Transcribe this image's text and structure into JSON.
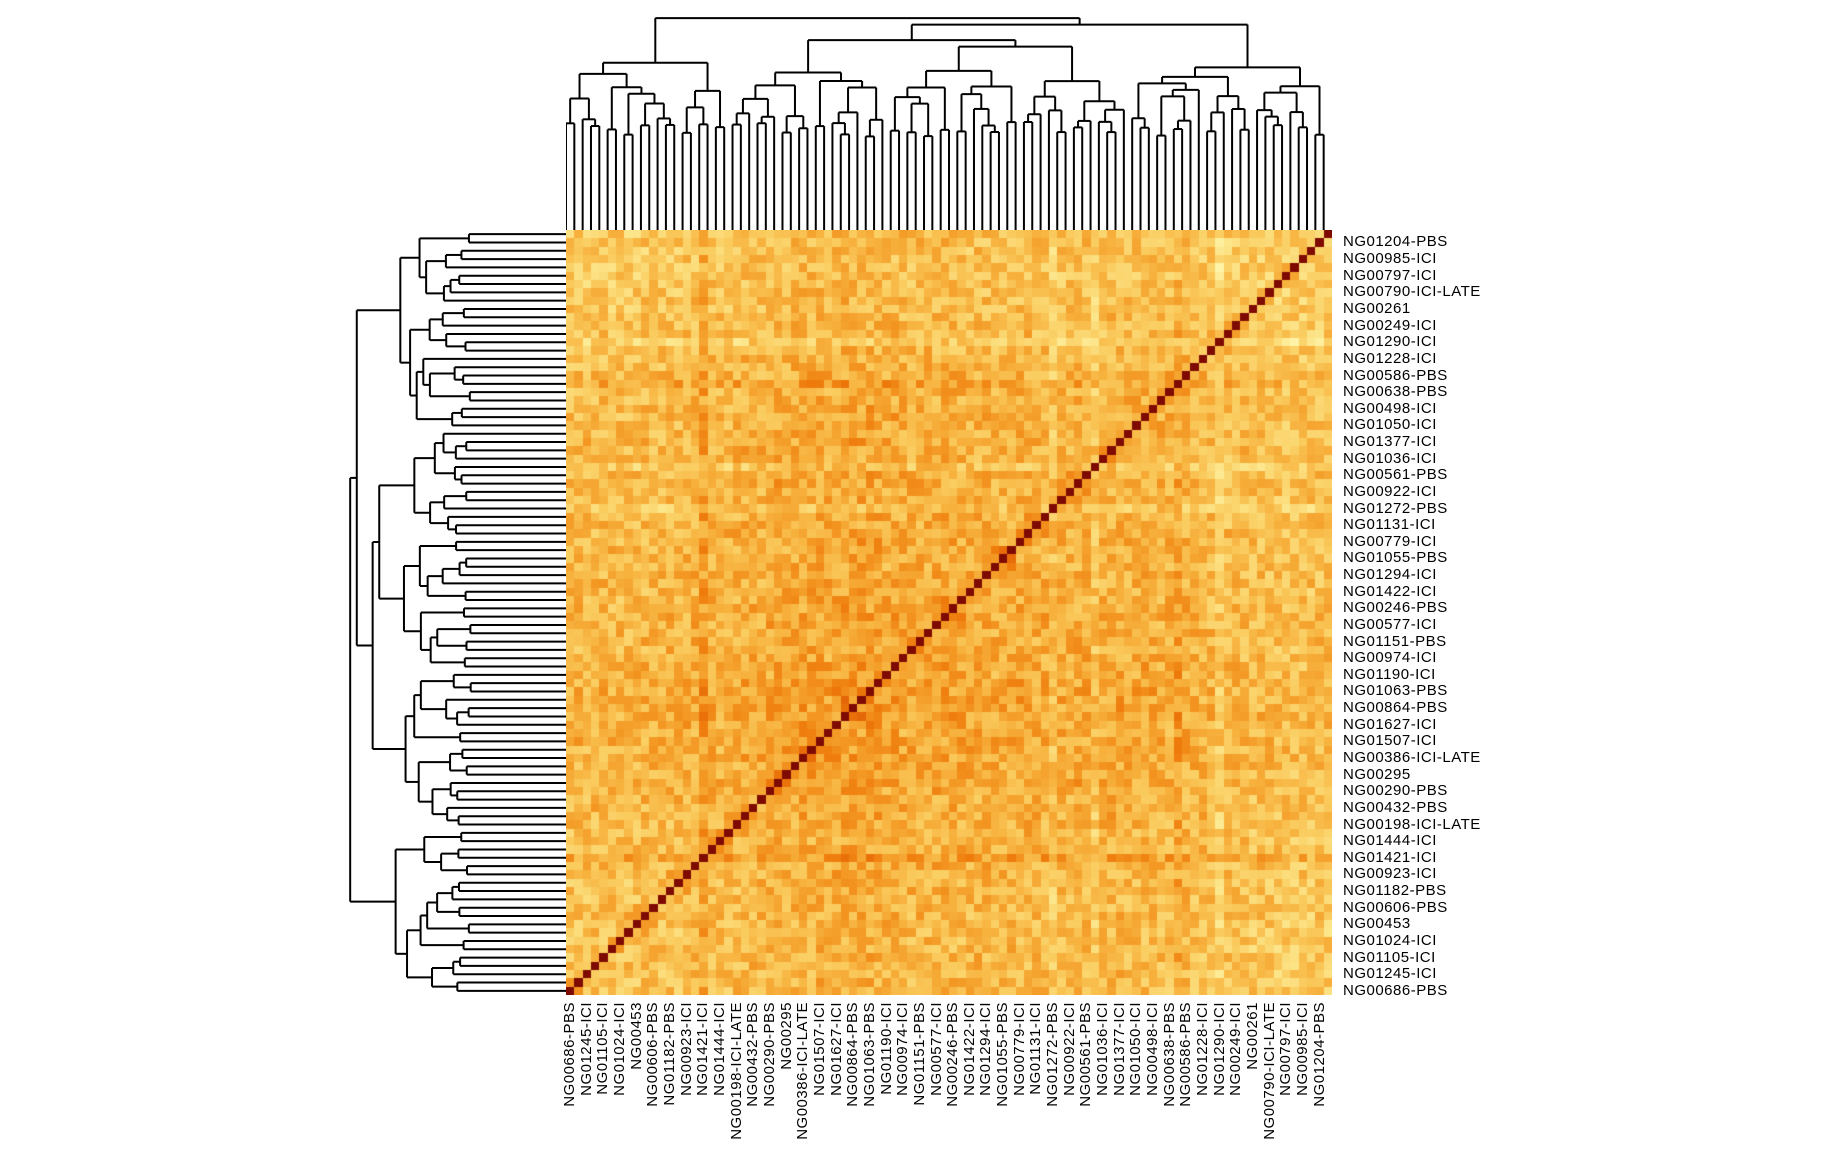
{
  "chart_data": {
    "type": "heatmap",
    "subtype": "hierarchically-clustered symmetric sample-distance matrix with dendrograms",
    "matrix": {
      "n_rows": 92,
      "n_cols": 92,
      "symmetric": true,
      "diagonal_value": 1,
      "value_range": [
        0,
        1
      ]
    },
    "label_step": 2,
    "row_labels": [
      "NG01204-PBS",
      "NG00985-ICI",
      "NG00797-ICI",
      "NG00790-ICI-LATE",
      "NG00261",
      "NG00249-ICI",
      "NG01290-ICI",
      "NG01228-ICI",
      "NG00586-PBS",
      "NG00638-PBS",
      "NG00498-ICI",
      "NG01050-ICI",
      "NG01377-ICI",
      "NG01036-ICI",
      "NG00561-PBS",
      "NG00922-ICI",
      "NG01272-PBS",
      "NG01131-ICI",
      "NG00779-ICI",
      "NG01055-PBS",
      "NG01294-ICI",
      "NG01422-ICI",
      "NG00246-PBS",
      "NG00577-ICI",
      "NG01151-PBS",
      "NG00974-ICI",
      "NG01190-ICI",
      "NG01063-PBS",
      "NG00864-PBS",
      "NG01627-ICI",
      "NG01507-ICI",
      "NG00386-ICI-LATE",
      "NG00295",
      "NG00290-PBS",
      "NG00432-PBS",
      "NG00198-ICI-LATE",
      "NG01444-ICI",
      "NG01421-ICI",
      "NG00923-ICI",
      "NG01182-PBS",
      "NG00606-PBS",
      "NG00453",
      "NG01024-ICI",
      "NG01105-ICI",
      "NG01245-ICI",
      "NG00686-PBS"
    ],
    "col_labels": [
      "NG00686-PBS",
      "NG01245-ICI",
      "NG01105-ICI",
      "NG01024-ICI",
      "NG00453",
      "NG00606-PBS",
      "NG01182-PBS",
      "NG00923-ICI",
      "NG01421-ICI",
      "NG01444-ICI",
      "NG00198-ICI-LATE",
      "NG00432-PBS",
      "NG00290-PBS",
      "NG00295",
      "NG00386-ICI-LATE",
      "NG01507-ICI",
      "NG01627-ICI",
      "NG00864-PBS",
      "NG01063-PBS",
      "NG01190-ICI",
      "NG00974-ICI",
      "NG01151-PBS",
      "NG00577-ICI",
      "NG00246-PBS",
      "NG01422-ICI",
      "NG01294-ICI",
      "NG01055-PBS",
      "NG00779-ICI",
      "NG01131-ICI",
      "NG01272-PBS",
      "NG00922-ICI",
      "NG00561-PBS",
      "NG01036-ICI",
      "NG01377-ICI",
      "NG01050-ICI",
      "NG00498-ICI",
      "NG00638-PBS",
      "NG00586-PBS",
      "NG01228-ICI",
      "NG01290-ICI",
      "NG00249-ICI",
      "NG00261",
      "NG00790-ICI-LATE",
      "NG00797-ICI",
      "NG00985-ICI",
      "NG01204-PBS"
    ],
    "palette": {
      "name": "yellow-orange-red",
      "stops": [
        [
          0.0,
          "#FFFFC8"
        ],
        [
          0.12,
          "#FEF4A8"
        ],
        [
          0.25,
          "#FCE488"
        ],
        [
          0.4,
          "#FACC5F"
        ],
        [
          0.55,
          "#F7B03C"
        ],
        [
          0.68,
          "#F39420"
        ],
        [
          0.78,
          "#EE7A0B"
        ],
        [
          0.87,
          "#E05A05"
        ],
        [
          0.94,
          "#C03803"
        ],
        [
          1.0,
          "#7E0A02"
        ]
      ]
    },
    "dendrograms": {
      "top": true,
      "left": true,
      "color": "#000000"
    },
    "background": "#FFFFFF",
    "label_color": "#000000"
  }
}
